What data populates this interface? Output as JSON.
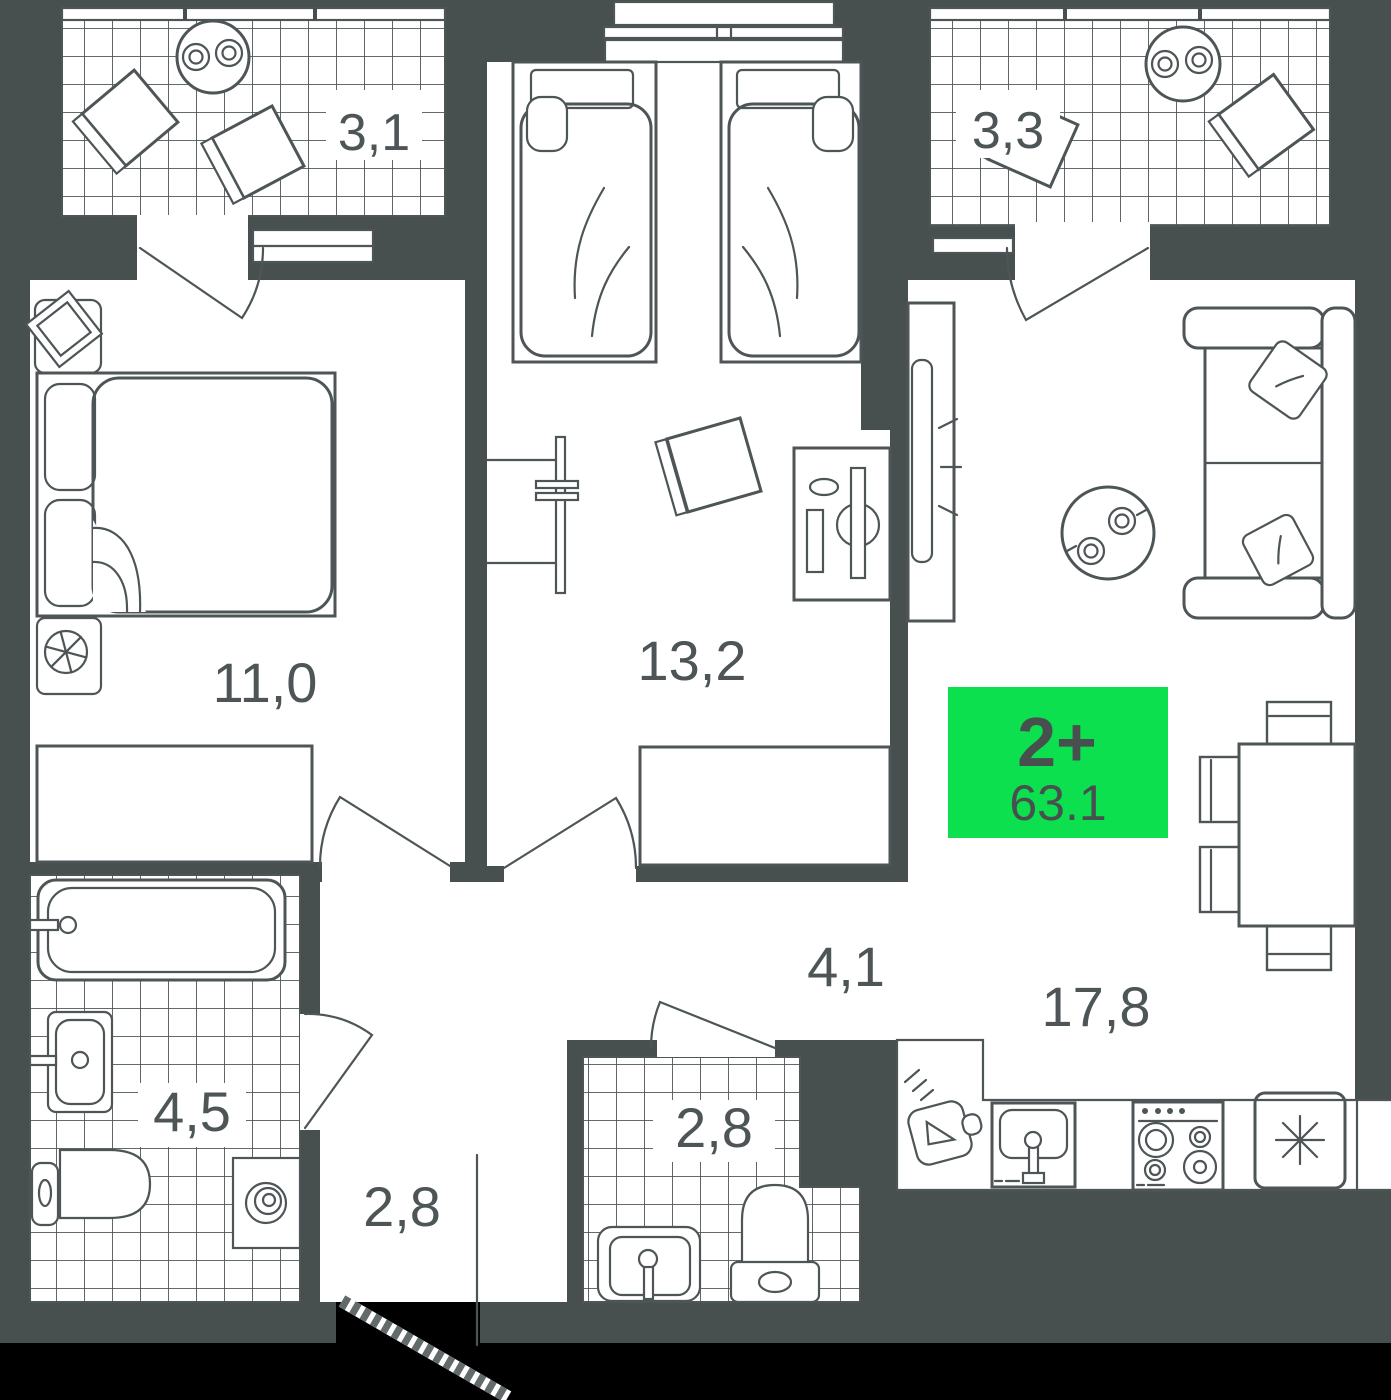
{
  "plan": {
    "badge": {
      "rooms": "2+",
      "area": "63.1"
    },
    "rooms": {
      "balcony_left": "3,1",
      "balcony_right": "3,3",
      "bedroom": "13,2",
      "master_bedroom": "11,0",
      "living_kitchen": "17,8",
      "bathroom": "4,5",
      "hallway": "4,1",
      "entry": "2,8",
      "wc": "2,8"
    },
    "colors": {
      "wall": "#47504F",
      "floor": "#FFFFFF",
      "line": "#4D5557",
      "accent": "#0CE04E",
      "badge_text": "#47504F",
      "outside": "#000000"
    }
  }
}
